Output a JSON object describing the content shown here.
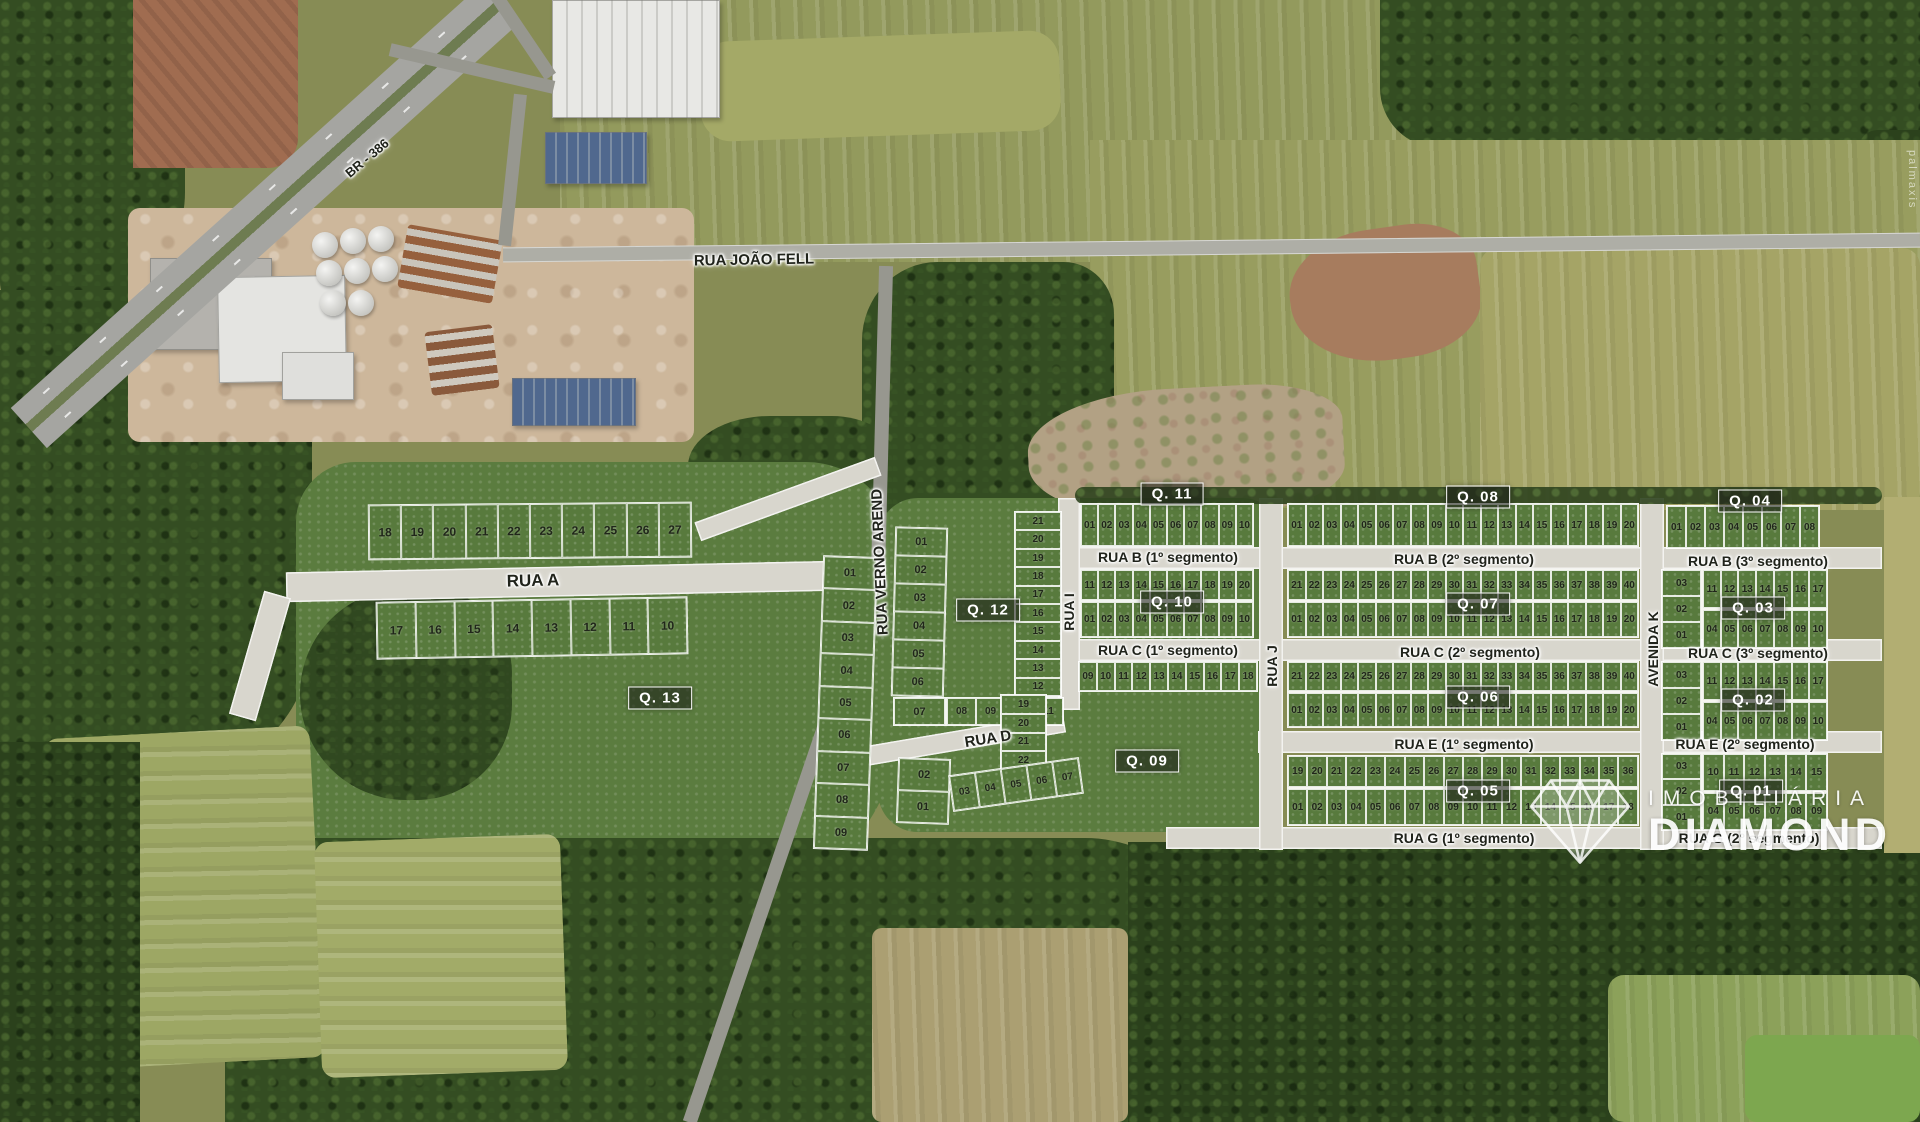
{
  "map": {
    "region_watermark": "palmaxis",
    "logo": {
      "brand_top": "IMOBILIÁRIA",
      "brand_main": "DIAMOND"
    },
    "streets": [
      {
        "id": "br386",
        "name": "BR - 386"
      },
      {
        "id": "rua-joao-fell",
        "name": "RUA JOÃO FELL"
      },
      {
        "id": "rua-verno-arend",
        "name": "RUA VERNO AREND"
      },
      {
        "id": "rua-a",
        "name": "RUA A"
      },
      {
        "id": "rua-d",
        "name": "RUA D"
      },
      {
        "id": "rua-i",
        "name": "RUA I"
      },
      {
        "id": "rua-j",
        "name": "RUA J"
      },
      {
        "id": "avenida-k",
        "name": "AVENIDA K"
      },
      {
        "id": "rua-b-1",
        "name": "RUA B (1º segmento)"
      },
      {
        "id": "rua-b-2",
        "name": "RUA B (2º segmento)"
      },
      {
        "id": "rua-b-3",
        "name": "RUA B (3º segmento)"
      },
      {
        "id": "rua-c-1",
        "name": "RUA C (1º segmento)"
      },
      {
        "id": "rua-c-2",
        "name": "RUA C (2º segmento)"
      },
      {
        "id": "rua-c-3",
        "name": "RUA C (3º segmento)"
      },
      {
        "id": "rua-e-1",
        "name": "RUA E (1º segmento)"
      },
      {
        "id": "rua-e-2",
        "name": "RUA E (2º segmento)"
      },
      {
        "id": "rua-g-1",
        "name": "RUA G (1º segmento)"
      },
      {
        "id": "rua-g-2",
        "name": "RUA G (2º segmento)"
      }
    ],
    "quadras": [
      {
        "id": "q01",
        "label": "Q. 01"
      },
      {
        "id": "q02",
        "label": "Q. 02"
      },
      {
        "id": "q03",
        "label": "Q. 03"
      },
      {
        "id": "q04",
        "label": "Q. 04"
      },
      {
        "id": "q05",
        "label": "Q. 05"
      },
      {
        "id": "q06",
        "label": "Q. 06"
      },
      {
        "id": "q07",
        "label": "Q. 07"
      },
      {
        "id": "q08",
        "label": "Q. 08"
      },
      {
        "id": "q09",
        "label": "Q. 09"
      },
      {
        "id": "q10",
        "label": "Q. 10"
      },
      {
        "id": "q11",
        "label": "Q. 11"
      },
      {
        "id": "q12",
        "label": "Q. 12"
      },
      {
        "id": "q13",
        "label": "Q. 13"
      }
    ],
    "blocks": [
      {
        "id": "q13-top",
        "quadra": "Q. 13",
        "lots": [
          "18",
          "19",
          "20",
          "21",
          "22",
          "23",
          "24",
          "25",
          "26",
          "27"
        ]
      },
      {
        "id": "q13-mid",
        "quadra": "Q. 13",
        "lots": [
          "17",
          "16",
          "15",
          "14",
          "13",
          "12",
          "11",
          "10"
        ]
      },
      {
        "id": "q13-east",
        "quadra": "Q. 13",
        "lots": [
          "01",
          "02",
          "03",
          "04",
          "05",
          "06",
          "07",
          "08",
          "09"
        ]
      },
      {
        "id": "q12-west",
        "quadra": "Q. 12",
        "lots": [
          "01",
          "02",
          "03",
          "04",
          "05",
          "06"
        ]
      },
      {
        "id": "q12-corner",
        "quadra": "Q. 12",
        "lots": [
          "07"
        ]
      },
      {
        "id": "q12-south",
        "quadra": "Q. 12",
        "lots": [
          "08",
          "09",
          "10",
          "11"
        ]
      },
      {
        "id": "q12-east",
        "quadra": "Q. 12",
        "lots": [
          "21",
          "20",
          "19",
          "18",
          "17",
          "16",
          "15",
          "14",
          "13",
          "12"
        ]
      },
      {
        "id": "q11-row",
        "quadra": "Q. 11",
        "lots": [
          "01",
          "02",
          "03",
          "04",
          "05",
          "06",
          "07",
          "08",
          "09",
          "10"
        ]
      },
      {
        "id": "q10-top",
        "quadra": "Q. 10",
        "lots": [
          "11",
          "12",
          "13",
          "14",
          "15",
          "16",
          "17",
          "18",
          "19",
          "20"
        ]
      },
      {
        "id": "q10-bot",
        "quadra": "Q. 10",
        "lots": [
          "01",
          "02",
          "03",
          "04",
          "05",
          "06",
          "07",
          "08",
          "09",
          "10"
        ]
      },
      {
        "id": "q09-top",
        "quadra": "Q. 09",
        "lots": [
          "09",
          "10",
          "11",
          "12",
          "13",
          "14",
          "15",
          "16",
          "17",
          "18"
        ]
      },
      {
        "id": "q09-east",
        "quadra": "Q. 09",
        "lots": [
          "19",
          "20",
          "21",
          "22",
          "23"
        ]
      },
      {
        "id": "q09-west",
        "quadra": "Q. 09",
        "lots": [
          "02",
          "01"
        ]
      },
      {
        "id": "q09-south",
        "quadra": "Q. 09",
        "lots": [
          "03",
          "04",
          "05",
          "06",
          "07"
        ]
      },
      {
        "id": "q08-row",
        "quadra": "Q. 08",
        "lots": [
          "01",
          "02",
          "03",
          "04",
          "05",
          "06",
          "07",
          "08",
          "09",
          "10",
          "11",
          "12",
          "13",
          "14",
          "15",
          "16",
          "17",
          "18",
          "19",
          "20"
        ]
      },
      {
        "id": "q07-top",
        "quadra": "Q. 07",
        "lots": [
          "21",
          "22",
          "23",
          "24",
          "25",
          "26",
          "27",
          "28",
          "29",
          "30",
          "31",
          "32",
          "33",
          "34",
          "35",
          "36",
          "37",
          "38",
          "39",
          "40"
        ]
      },
      {
        "id": "q07-bot",
        "quadra": "Q. 07",
        "lots": [
          "01",
          "02",
          "03",
          "04",
          "05",
          "06",
          "07",
          "08",
          "09",
          "10",
          "11",
          "12",
          "13",
          "14",
          "15",
          "16",
          "17",
          "18",
          "19",
          "20"
        ]
      },
      {
        "id": "q06-top",
        "quadra": "Q. 06",
        "lots": [
          "21",
          "22",
          "23",
          "24",
          "25",
          "26",
          "27",
          "28",
          "29",
          "30",
          "31",
          "32",
          "33",
          "34",
          "35",
          "36",
          "37",
          "38",
          "39",
          "40"
        ]
      },
      {
        "id": "q06-bot",
        "quadra": "Q. 06",
        "lots": [
          "01",
          "02",
          "03",
          "04",
          "05",
          "06",
          "07",
          "08",
          "09",
          "10",
          "11",
          "12",
          "13",
          "14",
          "15",
          "16",
          "17",
          "18",
          "19",
          "20"
        ]
      },
      {
        "id": "q05-top",
        "quadra": "Q. 05",
        "lots": [
          "19",
          "20",
          "21",
          "22",
          "23",
          "24",
          "25",
          "26",
          "27",
          "28",
          "29",
          "30",
          "31",
          "32",
          "33",
          "34",
          "35",
          "36"
        ]
      },
      {
        "id": "q05-bot",
        "quadra": "Q. 05",
        "lots": [
          "01",
          "02",
          "03",
          "04",
          "05",
          "06",
          "07",
          "08",
          "09",
          "10",
          "11",
          "12",
          "13",
          "14",
          "15",
          "16",
          "17",
          "18"
        ]
      },
      {
        "id": "q04-row",
        "quadra": "Q. 04",
        "lots": [
          "01",
          "02",
          "03",
          "04",
          "05",
          "06",
          "07",
          "08"
        ]
      },
      {
        "id": "q03-left",
        "quadra": "Q. 03",
        "lots": [
          "03",
          "02",
          "01"
        ]
      },
      {
        "id": "q03-top",
        "quadra": "Q. 03",
        "lots": [
          "11",
          "12",
          "13",
          "14",
          "15",
          "16",
          "17"
        ]
      },
      {
        "id": "q03-bot",
        "quadra": "Q. 03",
        "lots": [
          "04",
          "05",
          "06",
          "07",
          "08",
          "09",
          "10"
        ]
      },
      {
        "id": "q02-left",
        "quadra": "Q. 02",
        "lots": [
          "03",
          "02",
          "01"
        ]
      },
      {
        "id": "q02-top",
        "quadra": "Q. 02",
        "lots": [
          "11",
          "12",
          "13",
          "14",
          "15",
          "16",
          "17"
        ]
      },
      {
        "id": "q02-bot",
        "quadra": "Q. 02",
        "lots": [
          "04",
          "05",
          "06",
          "07",
          "08",
          "09",
          "10"
        ]
      },
      {
        "id": "q01-left",
        "quadra": "Q. 01",
        "lots": [
          "03",
          "02",
          "01"
        ]
      },
      {
        "id": "q01-top",
        "quadra": "Q. 01",
        "lots": [
          "10",
          "11",
          "12",
          "13",
          "14",
          "15"
        ]
      },
      {
        "id": "q01-bot",
        "quadra": "Q. 01",
        "lots": [
          "04",
          "05",
          "06",
          "07",
          "08",
          "09"
        ]
      }
    ],
    "colors": {
      "lot_green": "#587a3d",
      "road_new": "#d8d6cd",
      "road_asphalt": "#97978f",
      "label_box_bg": "rgba(28,31,24,0.58)",
      "label_text": "#ffffff",
      "street_text": "#20231b"
    }
  }
}
